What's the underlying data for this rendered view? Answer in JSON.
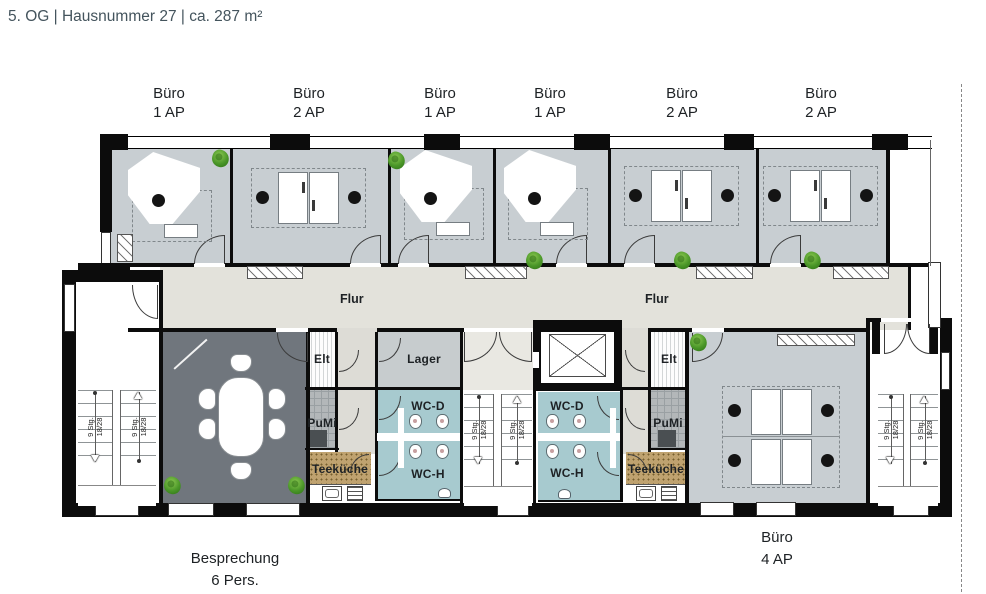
{
  "title": "5. OG | Hausnummer 27 | ca. 287 m²",
  "offices_top": [
    {
      "line1": "Büro",
      "line2": "1 AP"
    },
    {
      "line1": "Büro",
      "line2": "2 AP"
    },
    {
      "line1": "Büro",
      "line2": "1 AP"
    },
    {
      "line1": "Büro",
      "line2": "1 AP"
    },
    {
      "line1": "Büro",
      "line2": "2 AP"
    },
    {
      "line1": "Büro",
      "line2": "2 AP"
    }
  ],
  "corridor": {
    "flur_left": "Flur",
    "flur_right": "Flur"
  },
  "rooms": {
    "elt_left": "Elt",
    "pumi_left": "PuMi",
    "teekueche_left": "Teeküche",
    "lager": "Lager",
    "wc_d_left": "WC-D",
    "wc_h_left": "WC-H",
    "wc_d_right": "WC-D",
    "wc_h_right": "WC-H",
    "elt_right": "Elt",
    "pumi_right": "PuMi",
    "teekueche_right": "Teeküche"
  },
  "stairs": {
    "steps": "9 Stg.",
    "ratio": "18/28"
  },
  "annotations": {
    "meeting_line1": "Besprechung",
    "meeting_line2": "6 Pers.",
    "office4_line1": "Büro",
    "office4_line2": "4 AP"
  },
  "colors": {
    "wall": "#0c0c0c",
    "office_floor": "#c8ced2",
    "corridor_floor": "#e3e2db",
    "core_corridor_floor": "#dddcd6",
    "meeting_floor": "#70767d",
    "wc_floor": "#a7cacf",
    "kitchen_floor": "#bfa26f",
    "storage_floor": "#c7ccce",
    "pumi_floor": "#b3b7b9",
    "accent_plant": "#53a02e",
    "title_text": "#44545d",
    "label_text": "#1e2225"
  }
}
